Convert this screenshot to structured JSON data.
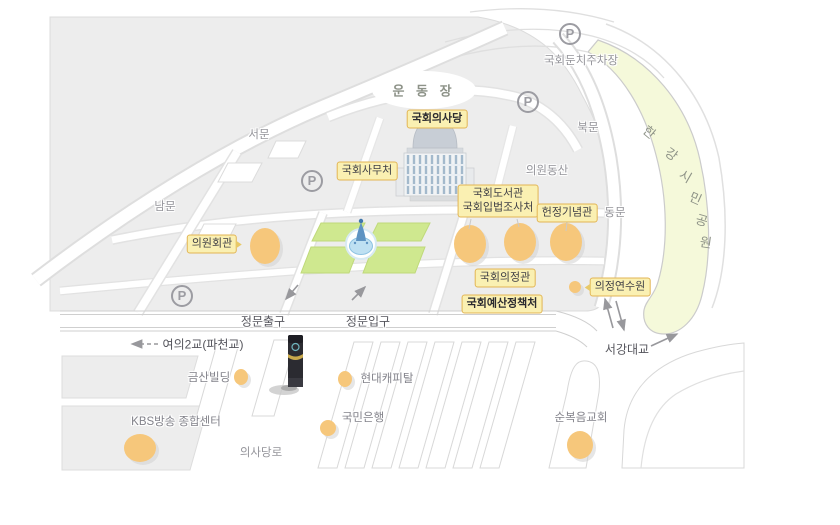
{
  "colors": {
    "label_bg": "#FAF0B2",
    "label_border": "#E2B554",
    "building_oval": "#F6C77B",
    "lawn_green": "#CFE88F",
    "park_green": "#F5F9DA",
    "block_gray": "#EDEDED",
    "muted_text": "#94949A",
    "dark_text": "#55555C"
  },
  "facilities": {
    "assembly_hall": "국회의사당",
    "secretariat": "국회사무처",
    "library": "국회도서관",
    "legislative_research": "국회입법조사처",
    "constitutional_memorial": "헌정기념관",
    "members_office": "의원회관",
    "uijeong_hall": "국회의정관",
    "training_institute": "의정연수원",
    "budget_office": "국회예산정책처"
  },
  "gates": {
    "west": "서문",
    "north": "북문",
    "south": "남문",
    "east": "동문"
  },
  "areas": {
    "playground": "운 동 장",
    "members_hill": "의원동산",
    "riverside_parking": "국회둔치주차장",
    "han_river_park_chars": [
      "한",
      "강",
      "시",
      "민",
      "공",
      "원"
    ]
  },
  "roads": {
    "main_gate_exit": "정문출구",
    "main_gate_entrance": "정문입구",
    "yeoui_bridge": "여의2교(파천교)",
    "seogang_bridge": "서강대교",
    "uisadang_ro": "의사당로"
  },
  "landmarks": {
    "geumsan_building": "금산빌딩",
    "hyundai_capital": "현대캐피탈",
    "kbs_center": "KBS방송 종합센터",
    "kookmin_bank": "국민은행",
    "full_gospel_church": "순복음교회"
  },
  "icons": {
    "parking": "P"
  }
}
